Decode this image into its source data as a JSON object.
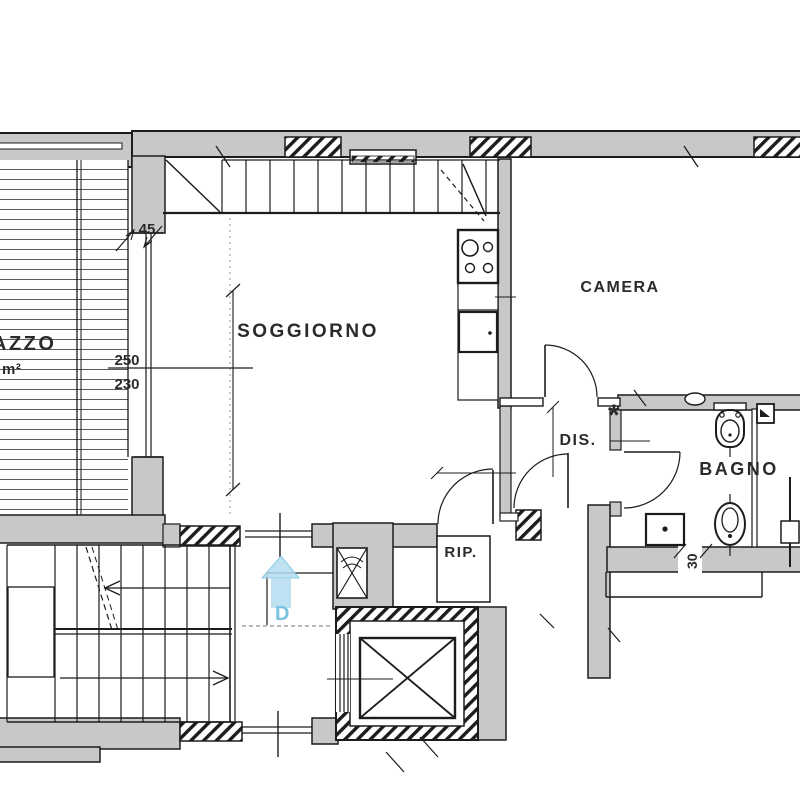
{
  "plan": {
    "title": "apartment-floor-plan",
    "rooms": {
      "living": "SOGGIORNO",
      "bedroom": "CAMERA",
      "hall": "DIS.",
      "bath": "BAGNO",
      "storage": "RIP.",
      "terrace_partial": "AZZO",
      "terrace_unit": "m²"
    },
    "dimensions": {
      "wall45": "45",
      "h250": "250",
      "h230": "230",
      "w30": "30"
    },
    "markers": {
      "door": "D",
      "note": "*"
    },
    "colors": {
      "wall_fill": "#c8c8c8",
      "line": "#1c1c1c",
      "marker_blue_fill": "#b3ddf0",
      "marker_blue_text": "#79c2e2"
    }
  }
}
